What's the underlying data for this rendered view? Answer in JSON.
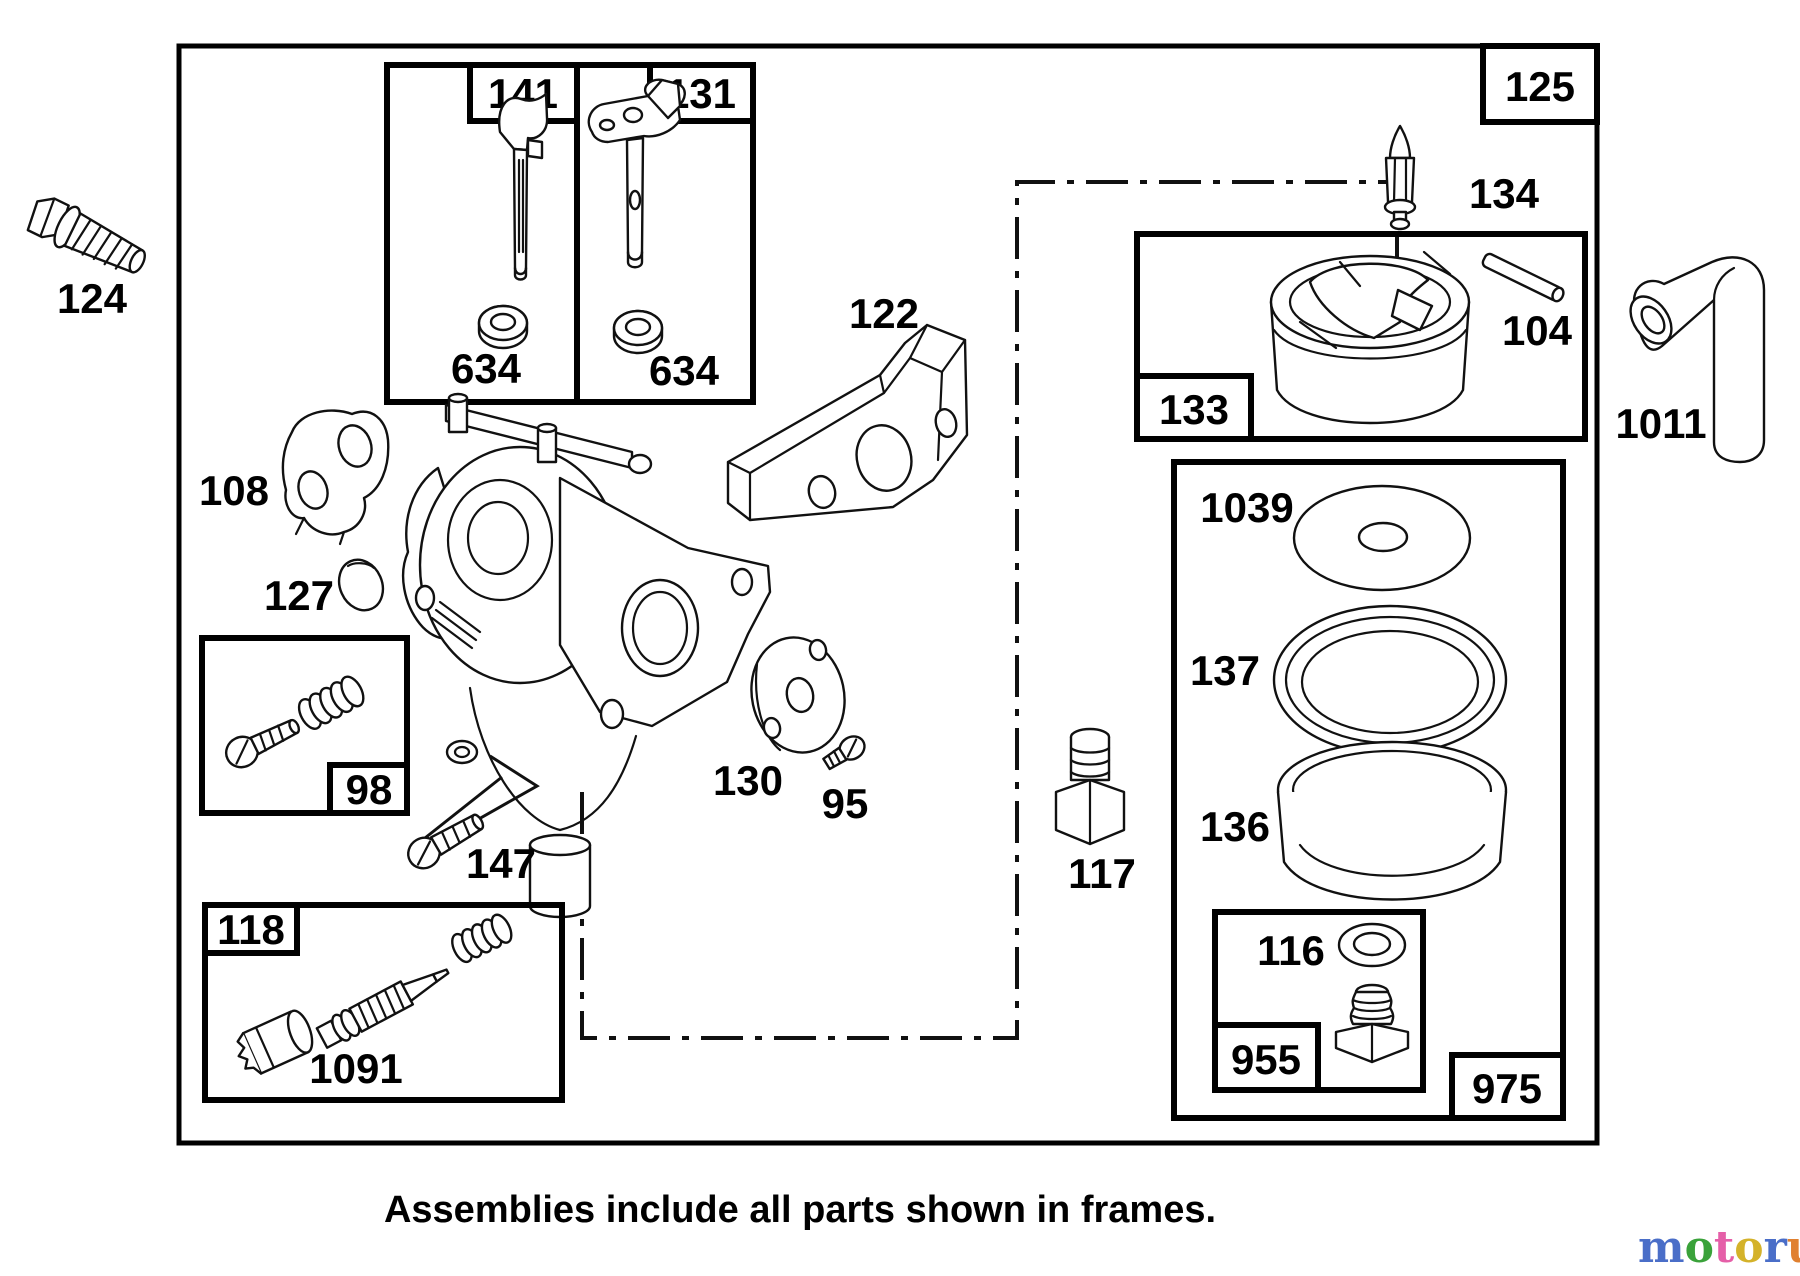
{
  "page": {
    "background": "#ffffff",
    "ink": "#000000"
  },
  "caption": {
    "text": "Assemblies include all parts shown in frames."
  },
  "labels": {
    "p125": "125",
    "p141": "141",
    "p131": "131",
    "p634a": "634",
    "p634b": "634",
    "p124": "124",
    "p108": "108",
    "p127": "127",
    "p122": "122",
    "p134": "134",
    "p104": "104",
    "p133": "133",
    "p1011": "1011",
    "p98": "98",
    "p147": "147",
    "p130": "130",
    "p95": "95",
    "p117": "117",
    "p1039": "1039",
    "p137": "137",
    "p136": "136",
    "p118": "118",
    "p1091": "1091",
    "p116": "116",
    "p955": "955",
    "p975": "975"
  },
  "watermark": {
    "letters": [
      {
        "ch": "m",
        "color": "#4a6ec8"
      },
      {
        "ch": "o",
        "color": "#3aa23a"
      },
      {
        "ch": "t",
        "color": "#e55fa8"
      },
      {
        "ch": "o",
        "color": "#d4b22a"
      },
      {
        "ch": "r",
        "color": "#4a6ec8"
      },
      {
        "ch": "u",
        "color": "#e08030"
      },
      {
        "ch": "f",
        "color": "#e8b820"
      }
    ],
    "tm": "™",
    "suffix": ".de",
    "suffix_color": "#3a3a3a"
  }
}
